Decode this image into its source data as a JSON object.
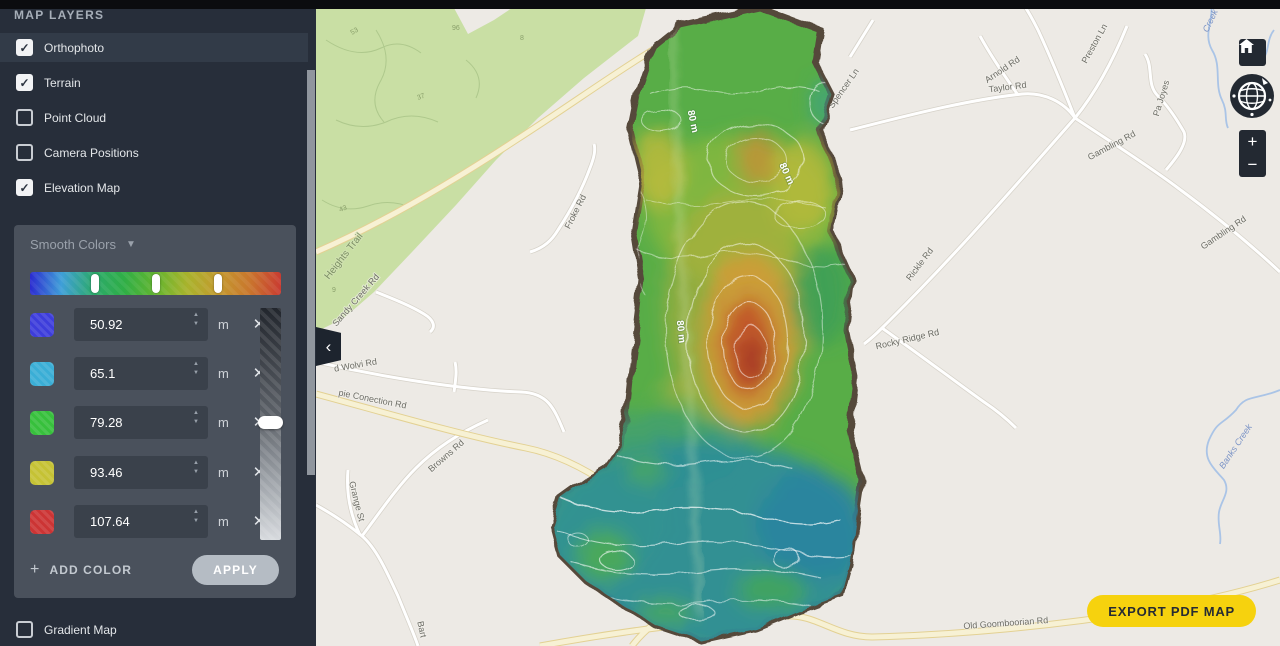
{
  "sidebar": {
    "header": "MAP LAYERS",
    "layers": [
      {
        "label": "Orthophoto",
        "checked": true
      },
      {
        "label": "Terrain",
        "checked": true
      },
      {
        "label": "Point Cloud",
        "checked": false
      },
      {
        "label": "Camera Positions",
        "checked": false
      },
      {
        "label": "Elevation Map",
        "checked": true
      }
    ],
    "color_panel": {
      "mode_label": "Smooth Colors",
      "gradient_colors": [
        "#2b2bd0",
        "#3f9fd8",
        "#2ca96e",
        "#2fae46",
        "#63b52f",
        "#a8b32c",
        "#c49a2e",
        "#c9762d",
        "#c93b31"
      ],
      "stops": [
        {
          "color": "#3d3ddb",
          "value": "50.92",
          "unit": "m"
        },
        {
          "color": "#3aaed6",
          "value": "65.1",
          "unit": "m"
        },
        {
          "color": "#37c03c",
          "value": "79.28",
          "unit": "m"
        },
        {
          "color": "#c5c234",
          "value": "93.46",
          "unit": "m"
        },
        {
          "color": "#cc3434",
          "value": "107.64",
          "unit": "m"
        }
      ],
      "add_color_label": "ADD COLOR",
      "apply_label": "APPLY"
    },
    "gradient_map": {
      "label": "Gradient Map",
      "checked": false
    }
  },
  "map": {
    "export_button": "EXPORT PDF MAP",
    "export_color": "#f6d20e",
    "controls": {
      "zoom_in": "+",
      "zoom_out": "−",
      "collapse": "‹"
    },
    "contour_labels": [
      {
        "text": "80 m"
      },
      {
        "text": "80 m"
      },
      {
        "text": "80 m"
      }
    ],
    "road_labels": [
      {
        "text": "Heights Trail"
      },
      {
        "text": "Sandy Creek Rd"
      },
      {
        "text": "Froke Rd"
      },
      {
        "text": "d Wolvi Rd"
      },
      {
        "text": "pie Conection Rd"
      },
      {
        "text": "Browns Rd"
      },
      {
        "text": "Grange St"
      },
      {
        "text": "Bart"
      },
      {
        "text": "Spencer Ln"
      },
      {
        "text": "Arnold Rd"
      },
      {
        "text": "Taylor Rd"
      },
      {
        "text": "Preston Ln"
      },
      {
        "text": "Pa Joyes"
      },
      {
        "text": "Gambling Rd"
      },
      {
        "text": "Gambling Rd"
      },
      {
        "text": "Rickle Rd"
      },
      {
        "text": "Rocky Ridge Rd"
      },
      {
        "text": "Old Goomboorian Rd"
      }
    ],
    "creek_labels": [
      {
        "text": "Banks Creek"
      },
      {
        "text": "Creek"
      }
    ],
    "terrain_numbers": [
      {
        "text": "53"
      },
      {
        "text": "96"
      },
      {
        "text": "8"
      },
      {
        "text": "37"
      },
      {
        "text": "43"
      },
      {
        "text": "9"
      }
    ]
  }
}
